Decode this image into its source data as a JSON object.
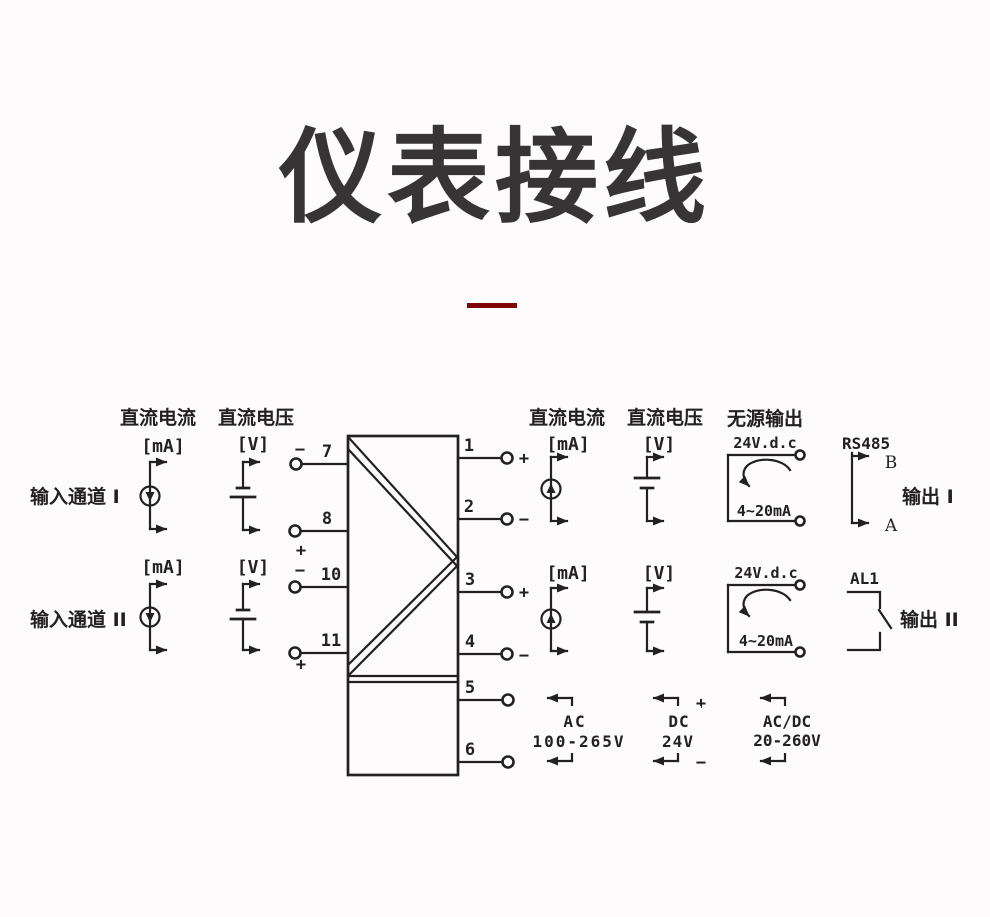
{
  "title": {
    "text": "仪表接线"
  },
  "theme": {
    "accent": "#7e0406",
    "ink": "#242021",
    "background": "#fdfbfc"
  },
  "diagram": {
    "input_headers": {
      "current": "直流电流",
      "voltage": "直流电压"
    },
    "output_headers": {
      "current": "直流电流",
      "voltage": "直流电压",
      "passive": "无源输出"
    },
    "channels": {
      "ch1": {
        "label": "输入通道 I",
        "ma": "[mA]",
        "v": "[V]"
      },
      "ch2": {
        "label": "输入通道 II",
        "ma": "[mA]",
        "v": "[V]"
      }
    },
    "terminals": {
      "t1": "1",
      "t2": "2",
      "t3": "3",
      "t4": "4",
      "t5": "5",
      "t6": "6",
      "t7": "7",
      "t8": "8",
      "t10": "10",
      "t11": "11"
    },
    "signs": {
      "plus": "+",
      "minus": "−"
    },
    "outputs": {
      "row1": {
        "ma": "[mA]",
        "v": "[V]",
        "passive_v": "24V.d.c",
        "passive_range": "4~20mA",
        "bus": "RS485",
        "b": "B",
        "a": "A",
        "label": "输出 I"
      },
      "row2": {
        "ma": "[mA]",
        "v": "[V]",
        "passive_v": "24V.d.c",
        "passive_range": "4~20mA",
        "alarm": "AL1",
        "label": "输出 II"
      }
    },
    "power": {
      "ac": {
        "l1": "AC",
        "l2": "100-265V"
      },
      "dc": {
        "l1": "DC",
        "l2": "24V",
        "plus": "+",
        "minus": "−"
      },
      "acdc": {
        "l1": "AC/DC",
        "l2": "20-260V"
      }
    }
  }
}
